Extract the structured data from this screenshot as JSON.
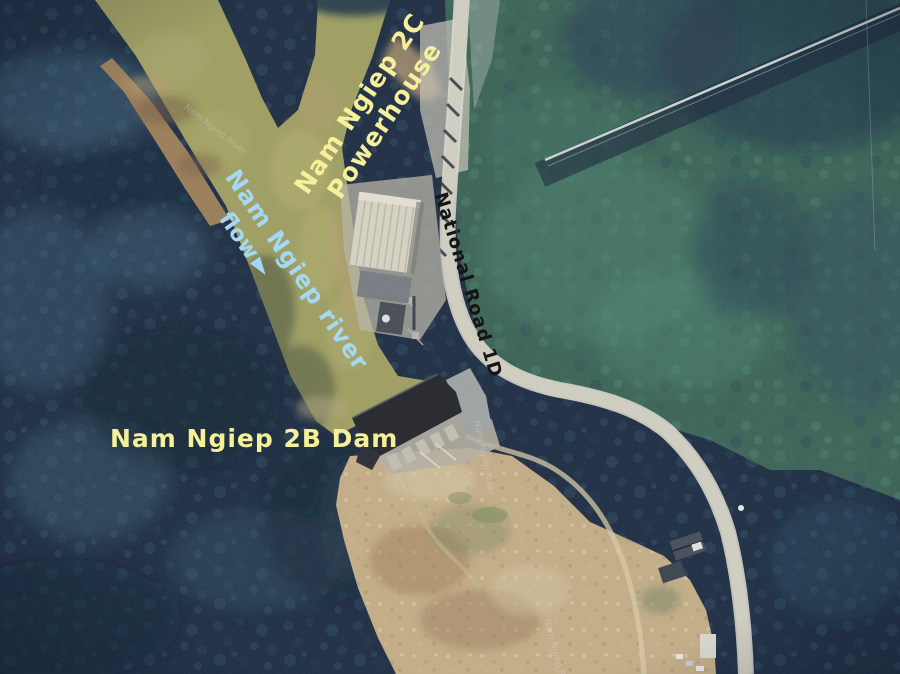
{
  "map": {
    "type": "satellite",
    "annotations": {
      "powerhouse_line1": "Nam Ngiep 2C",
      "powerhouse_line2": "Powerhouse",
      "river": "Nam Ngiep river",
      "flow": "flow",
      "flow_arrow": "►",
      "dam": "Nam Ngiep 2B Dam",
      "road": "National Road 1D"
    },
    "base_labels": [
      {
        "text": "Nam Ngiep River"
      },
      {
        "text": "Nam Ngiep River"
      },
      {
        "text": "Nam Ngiep River"
      }
    ],
    "colors": {
      "label_yellow": "#f7f09b",
      "label_blue": "#a3d9f5",
      "label_black": "#151515",
      "watermark": "#d8ecf8",
      "forest_dark": "#0e1e37",
      "forest_green": "#2e5a4c",
      "river_olive": "#9b9a58",
      "sandbar_brown": "#97774f",
      "cleared_tan": "#c3aa80",
      "road_gray": "#d2cec1",
      "dam_dark": "#15161d",
      "concrete": "#b3ad9e"
    }
  }
}
